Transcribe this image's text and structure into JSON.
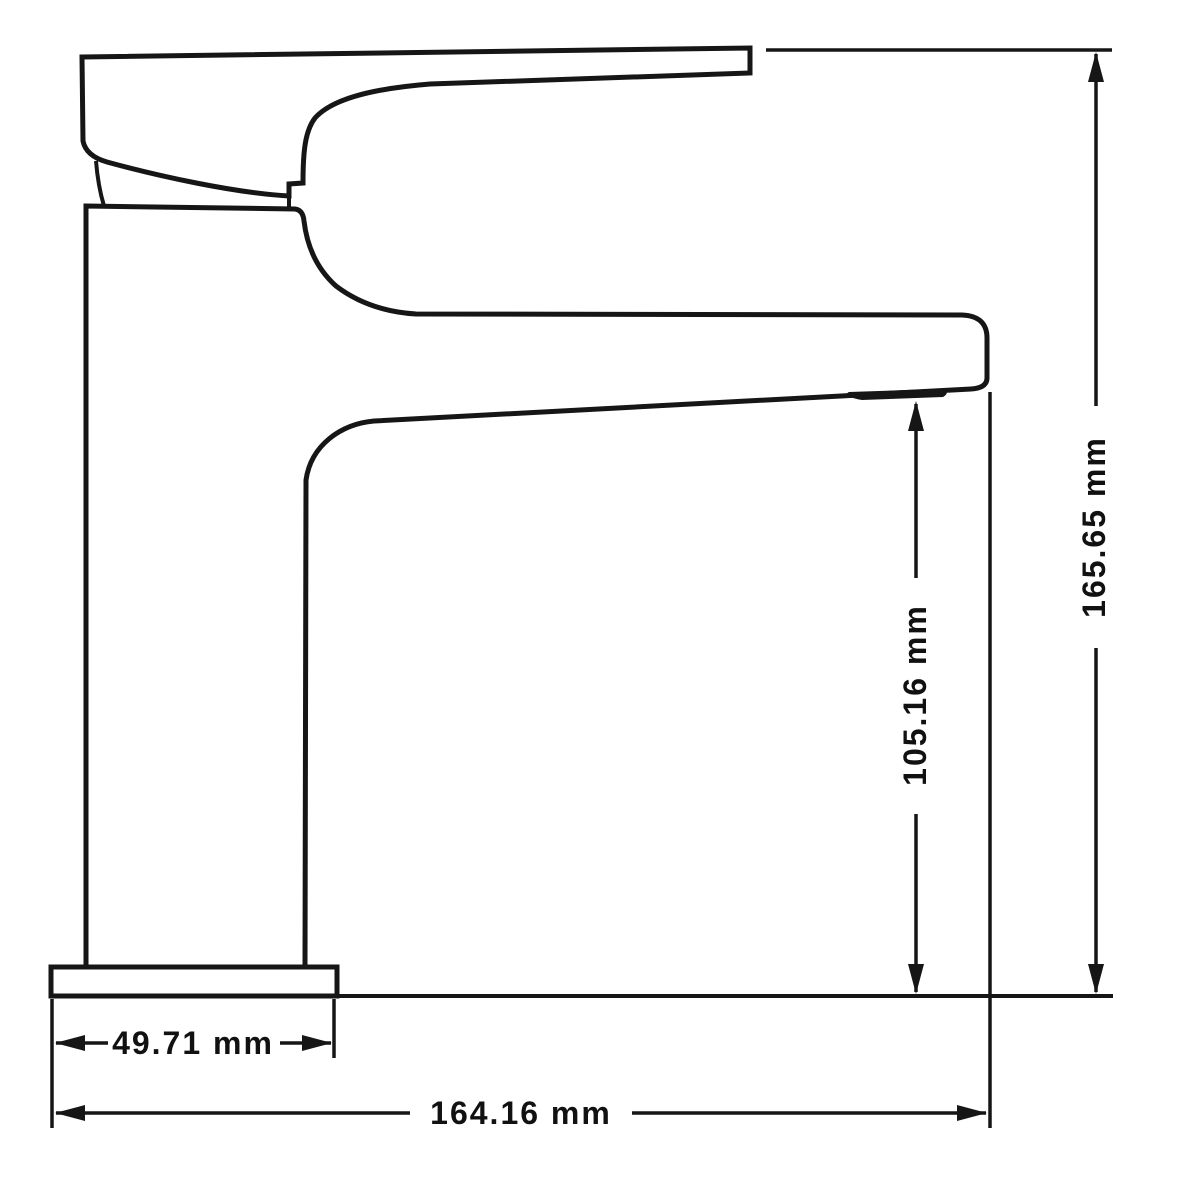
{
  "drawing": {
    "line_color": "#161616",
    "background_color": "#ffffff",
    "dimensions": {
      "overall_height": "165.65 mm",
      "spout_outlet_height": "105.16 mm",
      "base_width": "49.71 mm",
      "overall_length": "164.16 mm"
    }
  }
}
